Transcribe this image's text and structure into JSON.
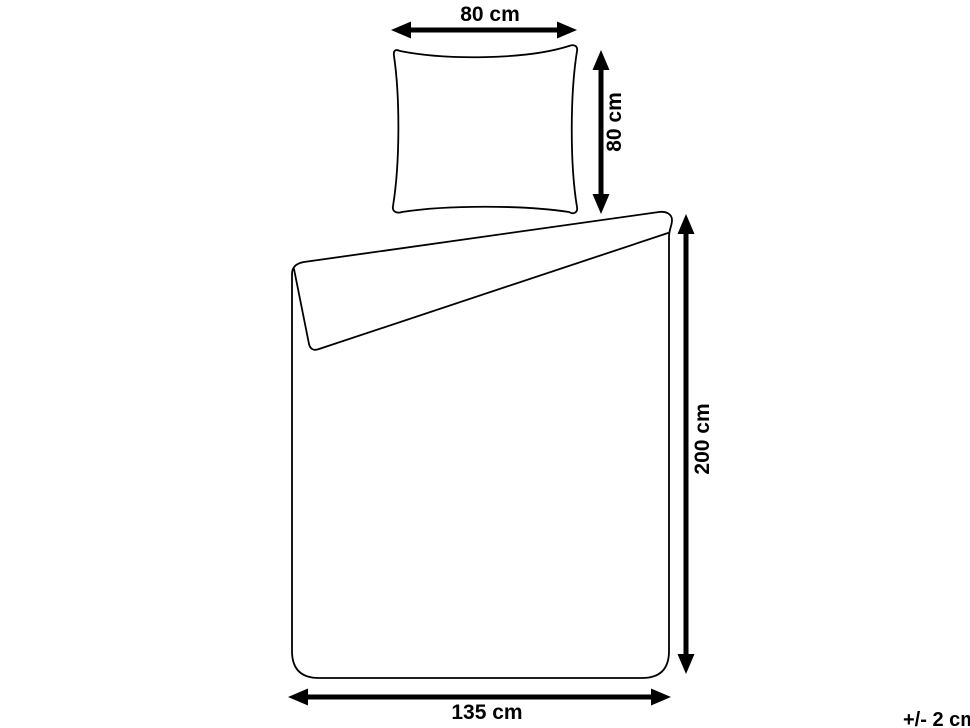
{
  "colors": {
    "background": "#ffffff",
    "line": "#000000",
    "text": "#000000"
  },
  "pillow": {
    "width_label": "80 cm",
    "height_label": "80 cm"
  },
  "duvet_cover": {
    "width_label": "135 cm",
    "height_label": "200 cm"
  },
  "tolerance_label": "+/- 2 cm"
}
